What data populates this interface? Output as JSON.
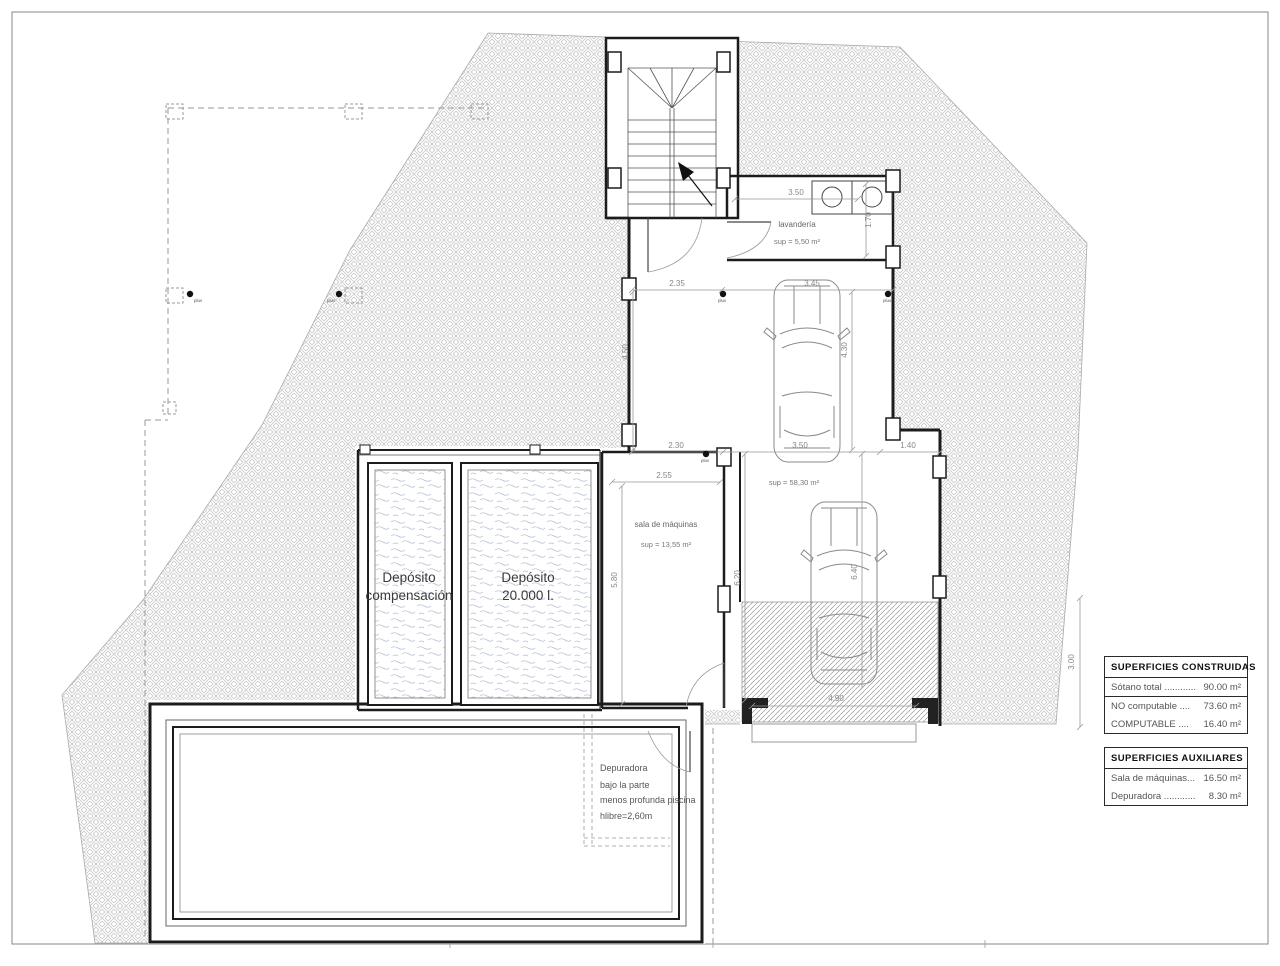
{
  "tables": {
    "constructed": {
      "header": "SUPERFICIES CONSTRUIDAS",
      "rows": [
        {
          "label": "Sótano total ............",
          "value": "90.00 m²"
        },
        {
          "label": "NO computable ....",
          "value": "73.60 m²"
        },
        {
          "label": "COMPUTABLE ....",
          "value": "16.40 m²"
        }
      ]
    },
    "auxiliary": {
      "header": "SUPERFICIES AUXILIARES",
      "rows": [
        {
          "label": "Sala de máquinas...",
          "value": "16.50 m²"
        },
        {
          "label": "Depuradora ............",
          "value": "8.30 m²"
        }
      ]
    }
  },
  "labels": {
    "laundry_name": "lavandería",
    "laundry_area": "sup = 5,50 m²",
    "garage_area": "sup = 58,30 m²",
    "machine_name": "sala de máquinas",
    "machine_area": "sup = 13,55 m²",
    "tank1_l1": "Depósito",
    "tank1_l2": "compensación",
    "tank2_l1": "Depósito",
    "tank2_l2": "20.000 l.",
    "pool_note_l1": "Depuradora",
    "pool_note_l2": "bajo la parte",
    "pool_note_l3": "menos profunda piscina",
    "pool_note_l4": "hlibre=2,60m"
  },
  "dims": {
    "lav_w": "3.50",
    "lav_h": "1.70",
    "hall_w": "2.35",
    "car_w": "3.45",
    "garage_h1": "4.50",
    "garage_h2": "4.30",
    "hall_w2": "2.30",
    "garage_w": "3.50",
    "step_w": "1.40",
    "machine_w": "2.55",
    "machine_h": "5.80",
    "garage_low_h1": "6.20",
    "garage_low_h2": "6.40",
    "ramp_w": "4.90",
    "ramp_h": "3.00"
  },
  "pluv": "pluv",
  "colors": {
    "wall": "#1c1c1c",
    "hatch": "#c6c6c6",
    "dimension": "#999999",
    "water": "#b5bfd2"
  }
}
